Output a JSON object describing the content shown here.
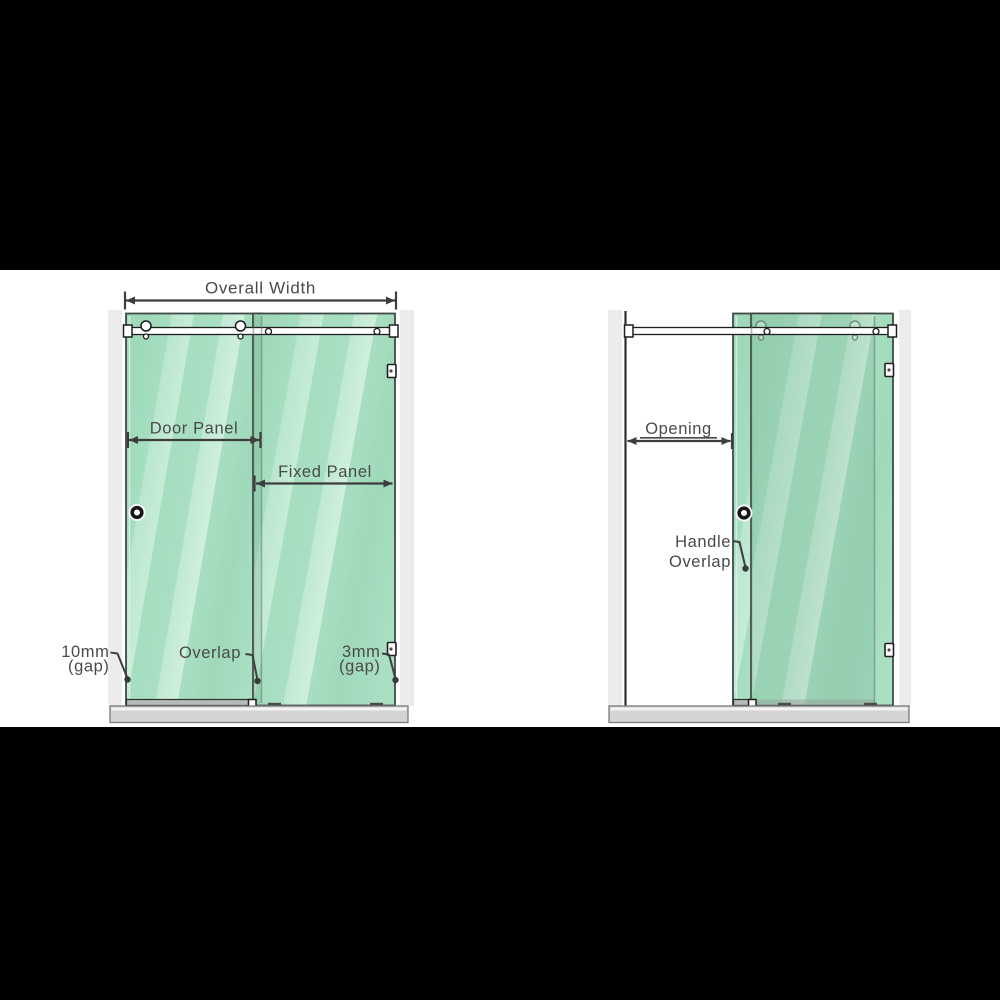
{
  "colors": {
    "letterbox_black": "#000000",
    "canvas_white": "#ffffff",
    "glass_green": "#a5dec1",
    "glass_highlight": "#cdeeda",
    "glass_edge": "#3f4a44",
    "wall_gray": "#ececec",
    "tray_gray": "#d4d4d4",
    "annotation_gray": "#4a4a4a",
    "hardware_outline": "#1f1f1f"
  },
  "left_diagram": {
    "overall_width_label": "Overall Width",
    "door_panel_label": "Door Panel",
    "fixed_panel_label": "Fixed Panel",
    "overlap_label": "Overlap",
    "left_gap_value": "10mm",
    "left_gap_unit": "(gap)",
    "right_gap_value": "3mm",
    "right_gap_unit": "(gap)"
  },
  "right_diagram": {
    "opening_label": "Opening",
    "handle_overlap_line1": "Handle",
    "handle_overlap_line2": "Overlap"
  }
}
